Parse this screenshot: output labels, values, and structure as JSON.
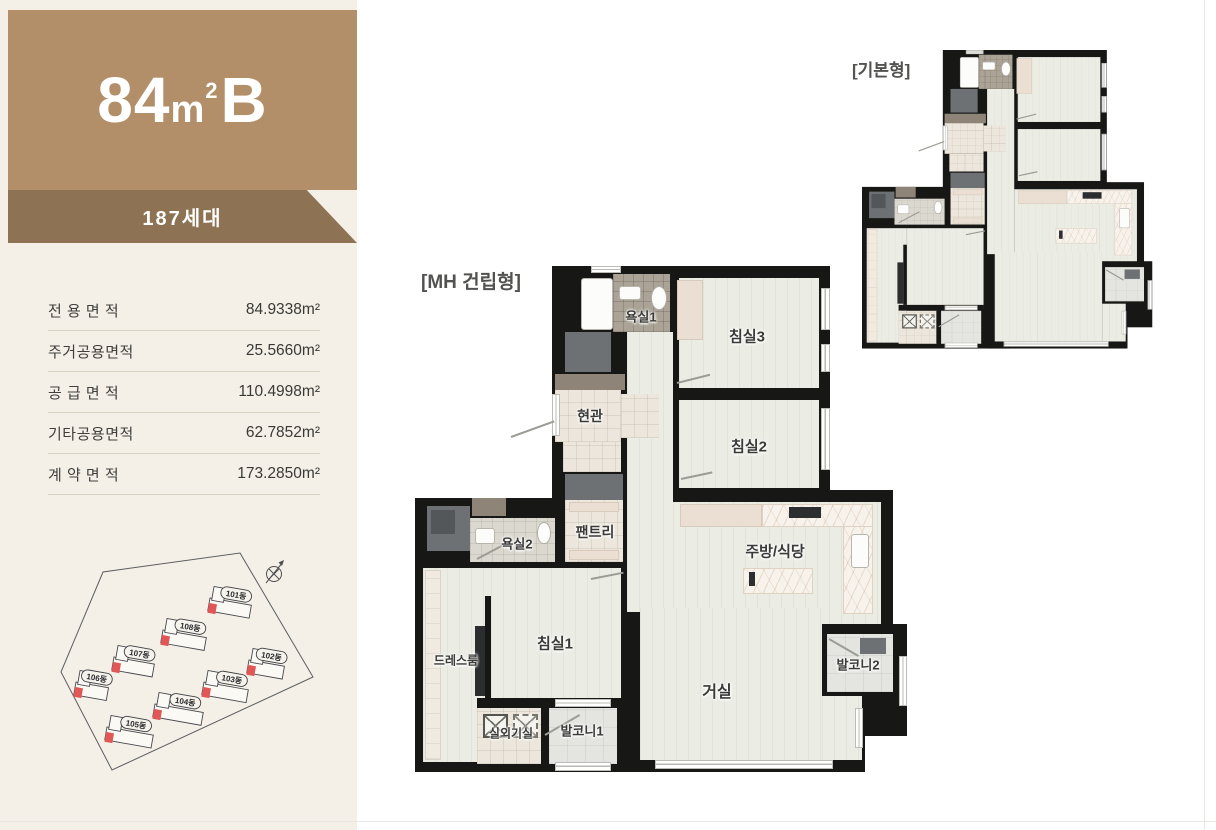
{
  "unit_panel": {
    "title": {
      "num": "84",
      "unit": "m",
      "sup": "2",
      "suffix": "B"
    },
    "households": "187세대",
    "colors": {
      "header_bg": "#b28f69",
      "band_bg": "#8e7254",
      "panel_bg": "#f4f0e8",
      "title_text": "#ffffff"
    },
    "areas": [
      {
        "label": "전 용 면 적",
        "value": "84.9338m²"
      },
      {
        "label": "주거공용면적",
        "value": "25.5660m²"
      },
      {
        "label": "공 급 면 적",
        "value": "110.4998m²"
      },
      {
        "label": "기타공용면적",
        "value": "62.7852m²"
      },
      {
        "label": "계 약 면 적",
        "value": "173.2850m²"
      }
    ]
  },
  "site_plan": {
    "angle_deg": 10,
    "accent_red": "#e15758",
    "buildings": [
      {
        "name": "101동",
        "bx": 210,
        "by": 598,
        "w": 42
      },
      {
        "name": "102동",
        "bx": 249,
        "by": 660,
        "w": 36
      },
      {
        "name": "103동",
        "bx": 204,
        "by": 682,
        "w": 45
      },
      {
        "name": "104동",
        "bx": 155,
        "by": 704,
        "w": 49
      },
      {
        "name": "105동",
        "bx": 107,
        "by": 727,
        "w": 47
      },
      {
        "name": "106동",
        "bx": 76,
        "by": 682,
        "w": 33
      },
      {
        "name": "107동",
        "bx": 114,
        "by": 657,
        "w": 41
      },
      {
        "name": "108동",
        "bx": 163,
        "by": 630,
        "w": 44
      }
    ]
  },
  "floor_plans": {
    "mh_label": "[MH 건립형]",
    "basic_label": "[기본형]",
    "wall_color": "#171715",
    "rooms": [
      {
        "name": "욕실1",
        "x": 226,
        "y": 50,
        "fs": 13
      },
      {
        "name": "침실3",
        "x": 332,
        "y": 70,
        "fs": 15
      },
      {
        "name": "현관",
        "x": 175,
        "y": 150,
        "fs": 14
      },
      {
        "name": "침실2",
        "x": 334,
        "y": 180,
        "fs": 15
      },
      {
        "name": "팬트리",
        "x": 180,
        "y": 266,
        "fs": 14
      },
      {
        "name": "욕실2",
        "x": 102,
        "y": 277,
        "fs": 13
      },
      {
        "name": "주방/식당",
        "x": 360,
        "y": 285,
        "fs": 15
      },
      {
        "name": "드레스룸",
        "x": 41,
        "y": 394,
        "fs": 12
      },
      {
        "name": "침실1",
        "x": 140,
        "y": 377,
        "fs": 15
      },
      {
        "name": "거실",
        "x": 302,
        "y": 424,
        "fs": 16
      },
      {
        "name": "발코니2",
        "x": 443,
        "y": 398,
        "fs": 13
      },
      {
        "name": "실외기실",
        "x": 96,
        "y": 467,
        "fs": 12
      },
      {
        "name": "발코니1",
        "x": 167,
        "y": 464,
        "fs": 13
      }
    ]
  }
}
